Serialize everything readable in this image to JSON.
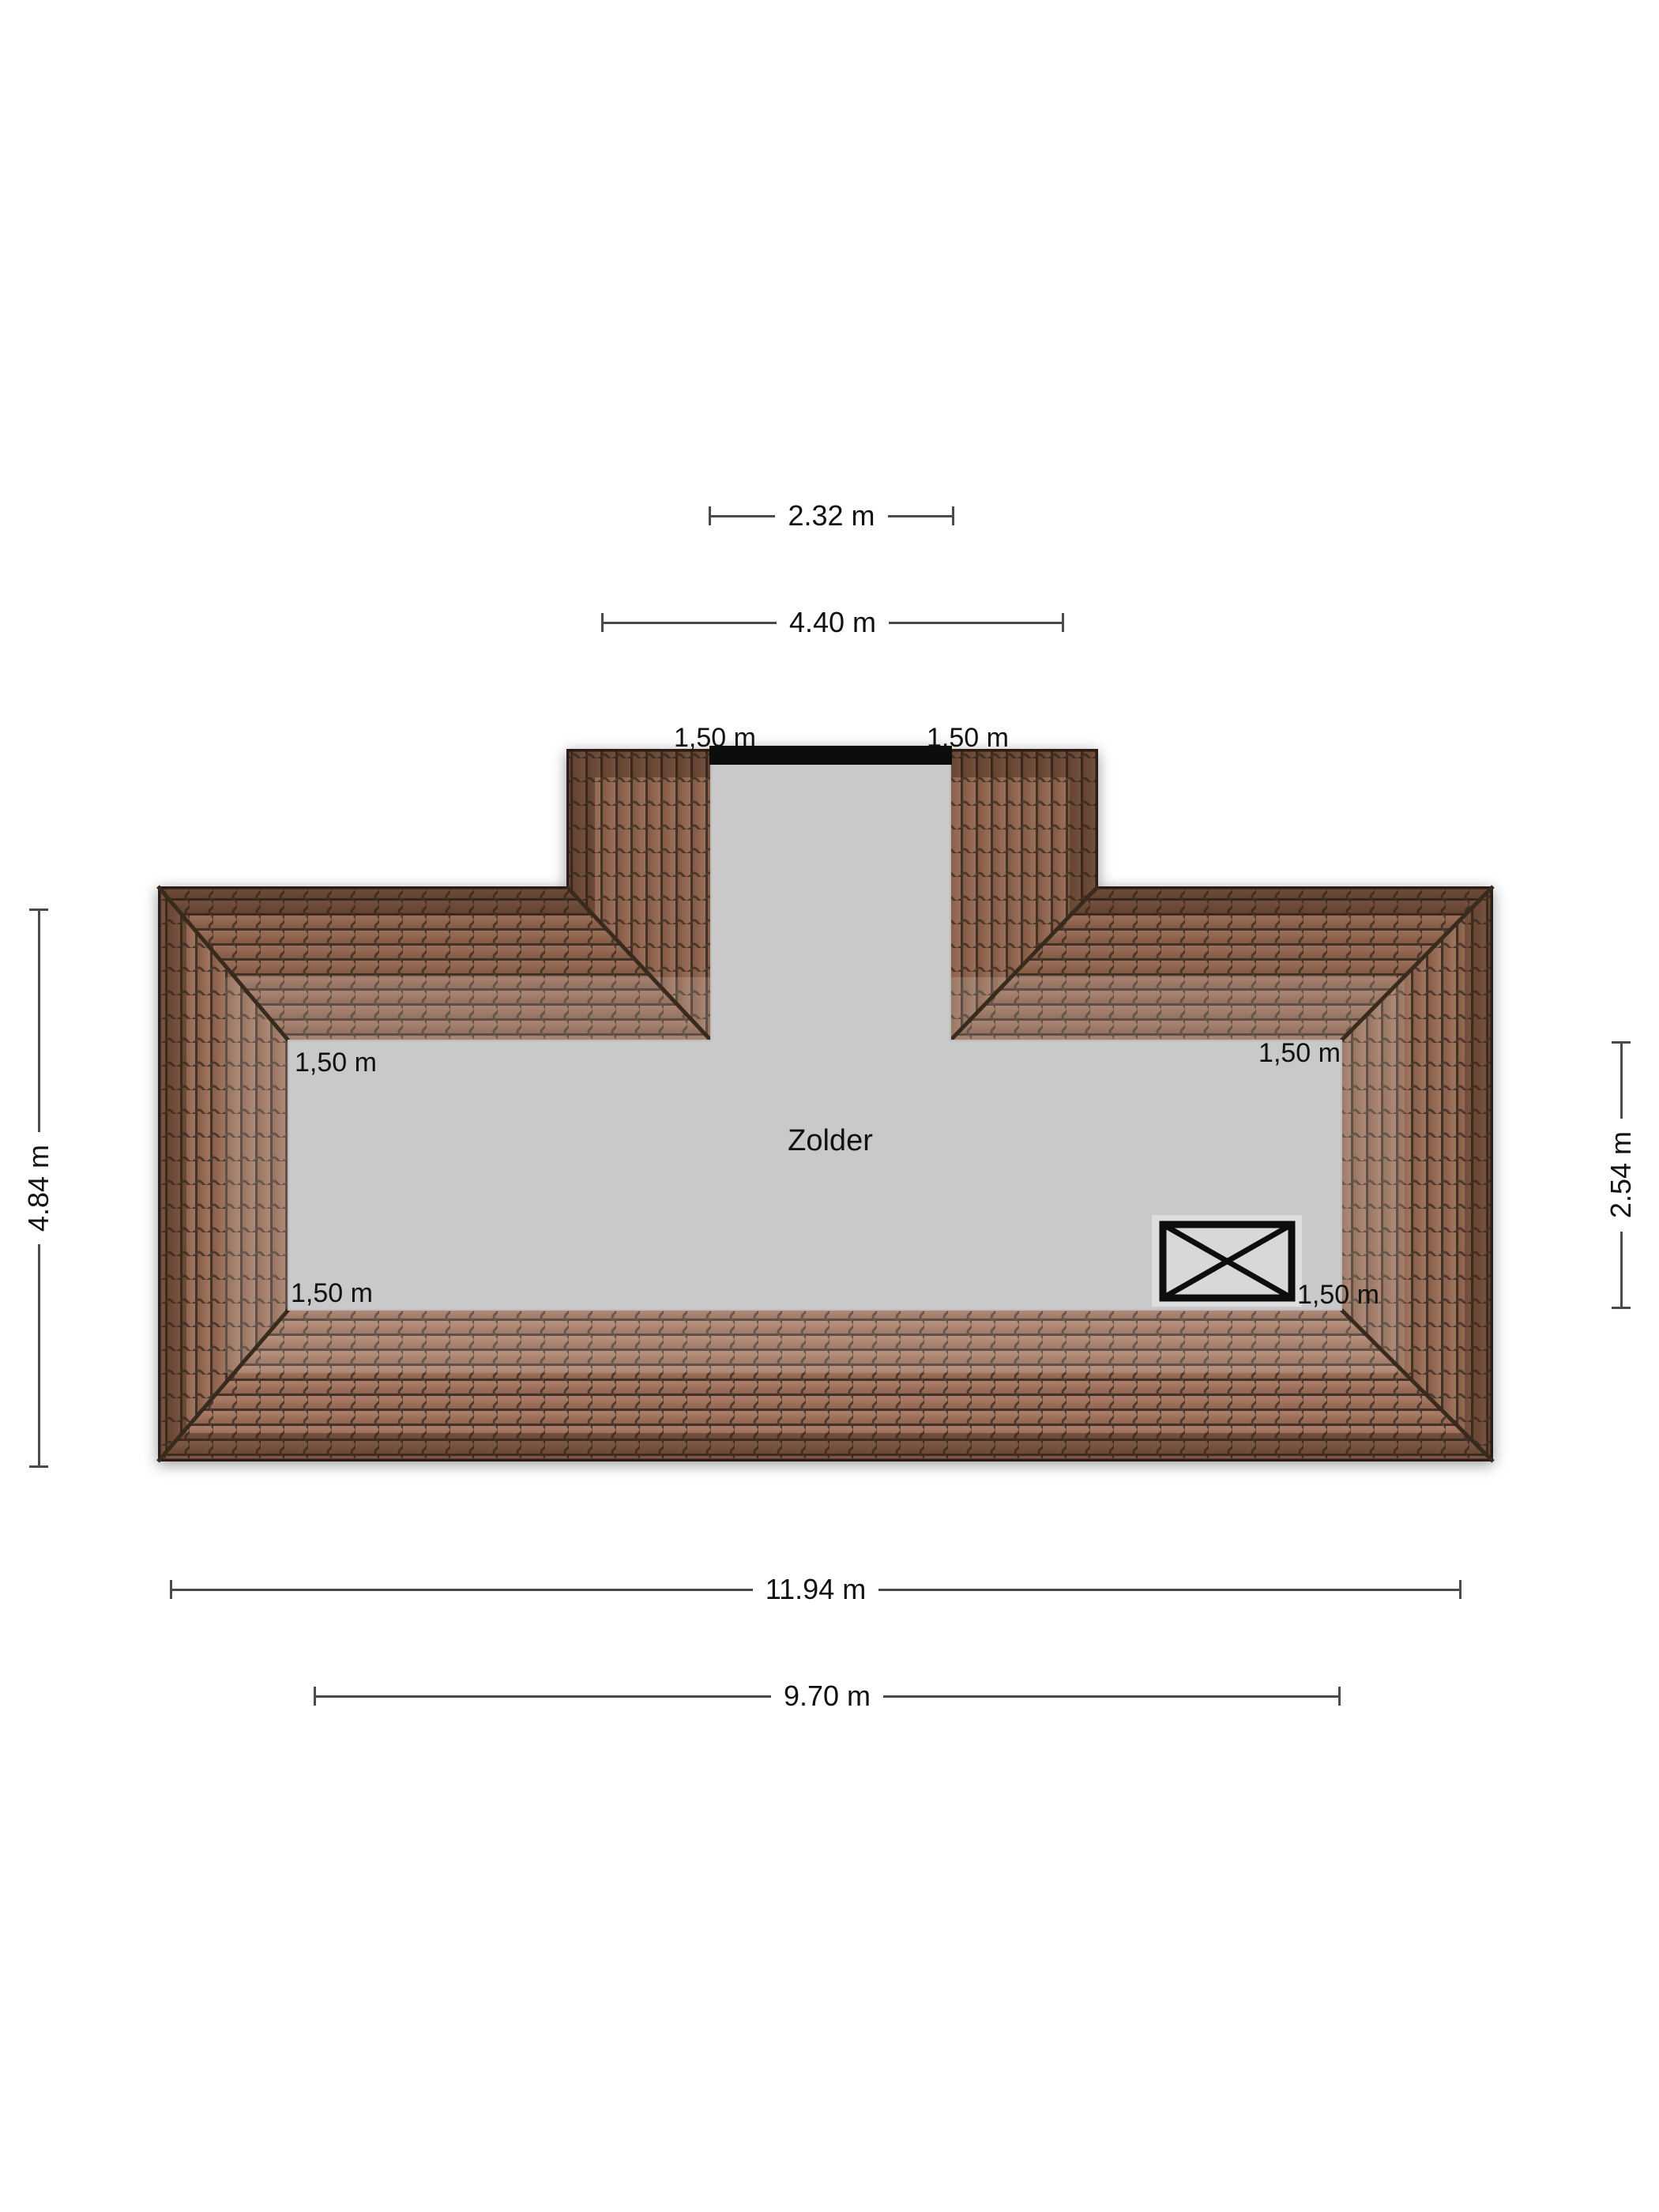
{
  "plan": {
    "room": {
      "label": "Zolder"
    },
    "window_symbol": "crossed-rectangle",
    "measurements": {
      "dormer_window_width": "2.32 m",
      "dormer_total_width": "4.40 m",
      "dormer_band_left": "1,50 m",
      "dormer_band_right": "1,50 m",
      "roof_border_top_left": "1,50 m",
      "roof_border_top_right": "1,50 m",
      "roof_border_bottom_left": "1,50 m",
      "roof_border_bottom_right": "1,50 m",
      "roof_total_depth": "4.84 m",
      "attic_floor_depth": "2.54 m",
      "roof_total_width": "11.94 m",
      "attic_floor_width": "9.70 m"
    },
    "colors": {
      "tile": "#9c6f5b",
      "tile_line": "#43332a",
      "tile_eaves": "#5a3f31",
      "floor": "#c9c9c9",
      "window_bar": "#0a0a0a",
      "dimension_line": "#4a4a4a",
      "text": "#111111",
      "background": "#ffffff"
    }
  }
}
